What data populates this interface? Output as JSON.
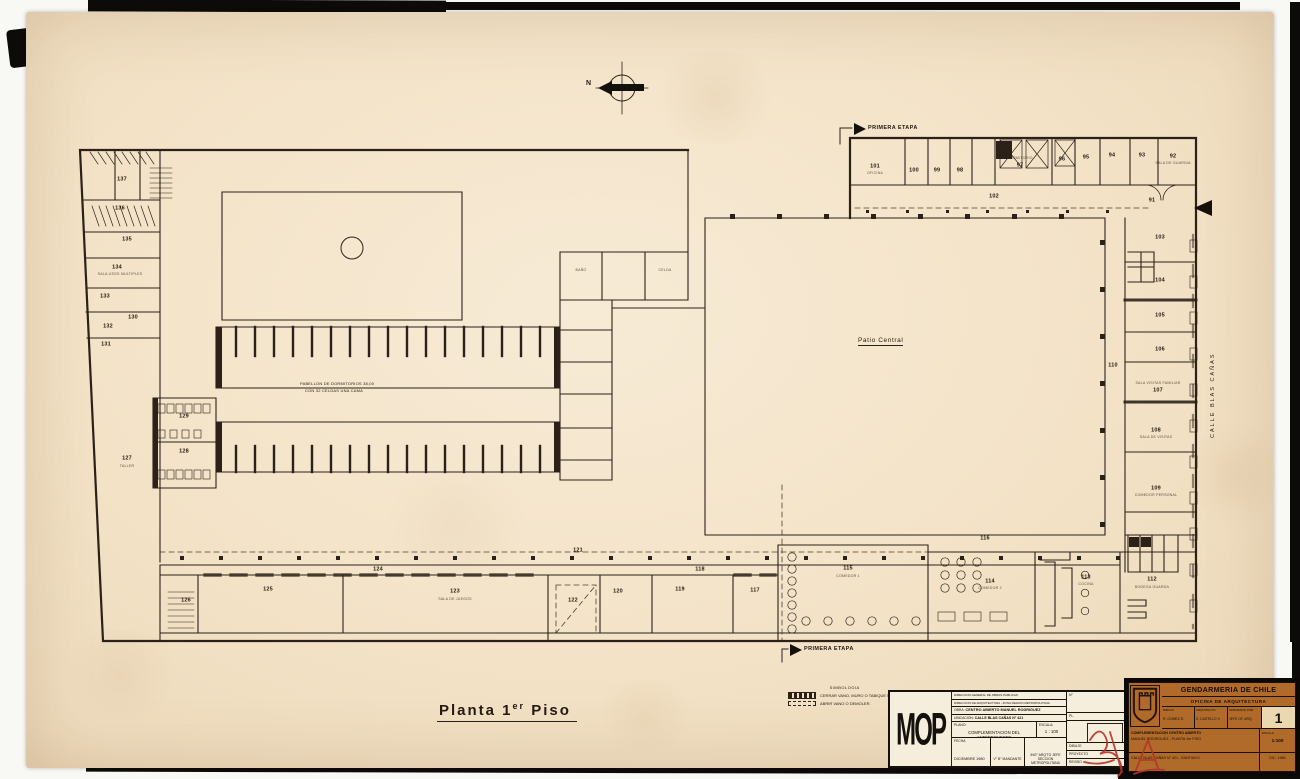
{
  "colors": {
    "paper": "#f3e2c6",
    "ink": "#2b2118",
    "titleblock_orange": "#b06a2a",
    "signature_red": "#b5342a"
  },
  "drawing": {
    "title_prefix": "Planta 1",
    "title_sup": "er",
    "title_suffix": " Piso",
    "north_label": "N",
    "stage_top": "PRIMERA ETAPA",
    "stage_bottom": "PRIMERA ETAPA",
    "patio_label": "Patio Central",
    "street_label": "CALLE  BLAS  CAÑAS",
    "pavilion_note_1": "PABELLON DE DORMITORIOS 38,00",
    "pavilion_note_2": "CON 32 CELDAS UNA CAMA"
  },
  "legend": {
    "title": "SIMBOLOGIA",
    "items": [
      {
        "style": "solid",
        "label": "CERRAR VANO, MURO O TABIQUE NUEVO"
      },
      {
        "style": "dashed",
        "label": "ABRIR VANO O DEMOLER."
      }
    ]
  },
  "rooms": [
    {
      "n": "91",
      "x": 1152,
      "y": 201
    },
    {
      "n": "92",
      "x": 1173,
      "y": 157
    },
    {
      "n": "93",
      "x": 1142,
      "y": 156
    },
    {
      "n": "94",
      "x": 1112,
      "y": 156
    },
    {
      "n": "95",
      "x": 1086,
      "y": 158
    },
    {
      "n": "96",
      "x": 1062,
      "y": 160
    },
    {
      "n": "97",
      "x": 1020,
      "y": 166
    },
    {
      "n": "98",
      "x": 960,
      "y": 171
    },
    {
      "n": "99",
      "x": 937,
      "y": 171
    },
    {
      "n": "100",
      "x": 914,
      "y": 171
    },
    {
      "n": "101",
      "x": 875,
      "y": 167
    },
    {
      "n": "102",
      "x": 994,
      "y": 197
    },
    {
      "n": "103",
      "x": 1160,
      "y": 238
    },
    {
      "n": "104",
      "x": 1160,
      "y": 281
    },
    {
      "n": "105",
      "x": 1160,
      "y": 316
    },
    {
      "n": "106",
      "x": 1160,
      "y": 350
    },
    {
      "n": "107",
      "x": 1158,
      "y": 391
    },
    {
      "n": "108",
      "x": 1156,
      "y": 431
    },
    {
      "n": "109",
      "x": 1156,
      "y": 489
    },
    {
      "n": "110",
      "x": 1113,
      "y": 366
    },
    {
      "n": "112",
      "x": 1152,
      "y": 580
    },
    {
      "n": "113",
      "x": 1086,
      "y": 578
    },
    {
      "n": "114",
      "x": 990,
      "y": 582
    },
    {
      "n": "115",
      "x": 848,
      "y": 569
    },
    {
      "n": "116",
      "x": 985,
      "y": 539
    },
    {
      "n": "117",
      "x": 755,
      "y": 591
    },
    {
      "n": "118",
      "x": 700,
      "y": 570
    },
    {
      "n": "119",
      "x": 680,
      "y": 590
    },
    {
      "n": "120",
      "x": 618,
      "y": 592
    },
    {
      "n": "121",
      "x": 578,
      "y": 551
    },
    {
      "n": "122",
      "x": 573,
      "y": 601
    },
    {
      "n": "123",
      "x": 455,
      "y": 592
    },
    {
      "n": "124",
      "x": 378,
      "y": 570
    },
    {
      "n": "125",
      "x": 268,
      "y": 590
    },
    {
      "n": "126",
      "x": 186,
      "y": 601
    },
    {
      "n": "127",
      "x": 127,
      "y": 459
    },
    {
      "n": "128",
      "x": 184,
      "y": 452
    },
    {
      "n": "129",
      "x": 184,
      "y": 417
    },
    {
      "n": "130",
      "x": 133,
      "y": 318
    },
    {
      "n": "131",
      "x": 106,
      "y": 345
    },
    {
      "n": "132",
      "x": 108,
      "y": 327
    },
    {
      "n": "133",
      "x": 105,
      "y": 297
    },
    {
      "n": "134",
      "x": 117,
      "y": 268
    },
    {
      "n": "135",
      "x": 127,
      "y": 240
    },
    {
      "n": "136",
      "x": 120,
      "y": 209
    },
    {
      "n": "137",
      "x": 122,
      "y": 180
    }
  ],
  "sublabels": [
    {
      "t": "TALLER",
      "x": 127,
      "y": 467
    },
    {
      "t": "SALA DE JUEGOS",
      "x": 455,
      "y": 600
    },
    {
      "t": "COMEDOR 1",
      "x": 848,
      "y": 577
    },
    {
      "t": "COMEDOR 2",
      "x": 990,
      "y": 589
    },
    {
      "t": "COCINA",
      "x": 1086,
      "y": 585
    },
    {
      "t": "BODEGA GUARDA",
      "x": 1152,
      "y": 588
    },
    {
      "t": "OFICINA",
      "x": 875,
      "y": 174
    },
    {
      "t": "DORMITORIO",
      "x": 1020,
      "y": 159
    },
    {
      "t": "SALA DE GUARDIA",
      "x": 1173,
      "y": 164
    },
    {
      "t": "SALA VISITAS FAMILIAR",
      "x": 1158,
      "y": 384
    },
    {
      "t": "SALA DE VISITAS",
      "x": 1156,
      "y": 438
    },
    {
      "t": "COMEDOR PERSONAL",
      "x": 1156,
      "y": 496
    },
    {
      "t": "BAÑO",
      "x": 581,
      "y": 271
    },
    {
      "t": "CELDA",
      "x": 665,
      "y": 271
    },
    {
      "t": "SALA USOS MULTIPLES",
      "x": 120,
      "y": 275
    }
  ],
  "mop_stamp": {
    "logo": "MOP",
    "dept_line1": "DIRECCION GENERAL DE OBRAS PUBLICAS",
    "dept_line2": "DIRECCION DE ARQUITECTURA - ZONA REGION METROPOLITANA",
    "obra_label": "OBRA:",
    "obra": "CENTRO ABIERTO MANUEL RODRIGUEZ",
    "ubicacion_label": "UBICACION:",
    "ubicacion": "CALLE BLAS CAÑAS N° 421",
    "plano_label": "PLANO:",
    "plano": "COMPLEMENTACION DEL ANTEPROYECTO",
    "escala_label": "ESCALA:",
    "escala": "1 : 100",
    "fecha_label": "FECHA",
    "fecha": "DICIEMBRE 1980",
    "mandante": "V° B° MANDANTE",
    "jefe_line1": "ING° ARQ'TO JEFE",
    "jefe_line2": "SECCION METROPOLITANA",
    "num_label": "N°",
    "pl_label": "PL.",
    "sign_rows": [
      "DIBUJO",
      "PROYECTO",
      "REVISO"
    ]
  },
  "title_block": {
    "org": "GENDARMERIA DE CHILE",
    "office": "OFICINA DE ARQUITECTURA",
    "cols": [
      {
        "label": "DIBUJO",
        "value": "R. GOMEZ S."
      },
      {
        "label": "ARQUITECTO",
        "value": "S. CASTILLO V."
      },
      {
        "label": "APROBADO POR",
        "value": "JEFE OF. ARQ."
      }
    ],
    "sheet_number": "1",
    "project_line1": "COMPLEMENTACION CENTRO ABIERTO",
    "project_line2": "MANUEL RODRIGUEZ - PLANTA 1er PISO",
    "escala_label": "ESCALA",
    "escala": "1:100",
    "address": "CALLE BLAS CAÑAS N° 421 - SANTIAGO",
    "fecha": "DIC. 1980"
  }
}
